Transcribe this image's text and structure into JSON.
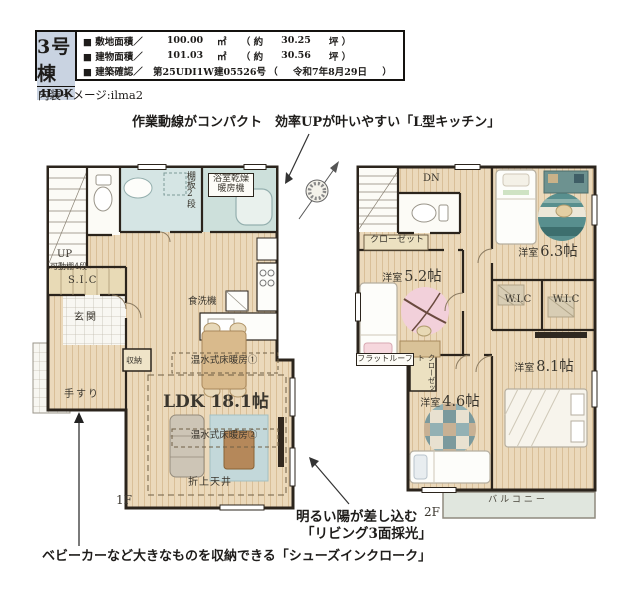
{
  "header": {
    "building": "3号棟",
    "plan_type": "4LDK",
    "rows": [
      {
        "label": "■ 敷地面積／",
        "value": "100.00",
        "unit": "㎡",
        "open": "（ 約",
        "value2": "30.25",
        "close": "坪 ）"
      },
      {
        "label": "■ 建物面積／",
        "value": "101.03",
        "unit": "㎡",
        "open": "（ 約",
        "value2": "30.56",
        "close": "坪 ）"
      },
      {
        "label": "■ 建築確認／",
        "value": "第25UDI1W建05526号",
        "unit": "",
        "open": "（",
        "value2": "令和7年8月29日",
        "close": "）"
      }
    ]
  },
  "notes": {
    "interior": "内装イメージ:ilma2",
    "kitchen": "作業動線がコンパクト　効率UPが叶いやすい「L型キッチン」",
    "living_1": "明るい陽が差し込む",
    "living_2": "「リビング3面採光」",
    "sic": "ベビーカーなど大きなものを収納できる「シューズインクローク」"
  },
  "floor1": {
    "floor_label": "1F",
    "labels": {
      "up": "UP",
      "shelf": "棚板2段",
      "bath_dryer": "浴室乾燥暖房機",
      "movable_shelf": "可動棚4段",
      "sic": "S.I.C",
      "entrance": "玄関",
      "handrail": "手すり",
      "storage": "収納",
      "dishwasher": "食洗機",
      "floor_heating_1": "温水式床暖房①",
      "ldk": "LDK 18.1帖",
      "floor_heating_2": "温水式床暖房②",
      "raised_ceiling": "折上天井"
    }
  },
  "floor2": {
    "floor_label": "2F",
    "labels": {
      "dn": "DN",
      "closet": "クローゼット",
      "closet_vertical": "クローゼット",
      "flat_roof": "フラットルーフ",
      "wic_left": "W.I.C",
      "wic_right": "W.I.C",
      "balcony": "バルコニー"
    },
    "rooms": [
      {
        "name": "洋室",
        "size": "5.2帖"
      },
      {
        "name": "洋室",
        "size": "6.3帖"
      },
      {
        "name": "洋室",
        "size": "4.6帖"
      },
      {
        "name": "洋室",
        "size": "8.1帖"
      }
    ]
  },
  "colors": {
    "header_cell_bg": "#c9d3e1",
    "wood_floor": "#ebd9bb",
    "bath_blue": "#d5e5e4",
    "wall": "#2b241c",
    "balcony": "#e0e6de",
    "rug_pink": "#f2d0da",
    "rug_teal": "#588f8e"
  }
}
